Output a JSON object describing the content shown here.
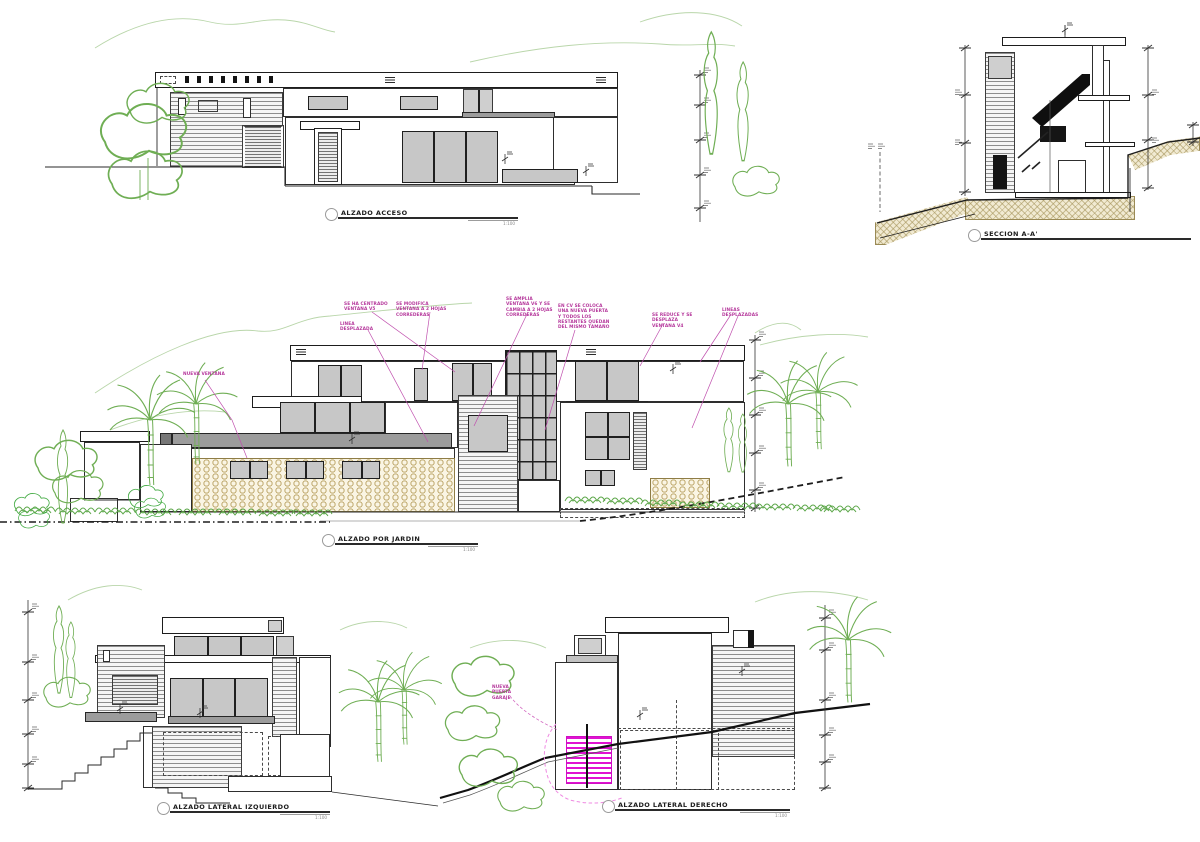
{
  "page": {
    "background": "#ffffff"
  },
  "palette": {
    "line": "#2b2b2b",
    "glass_fill": "#c7c7c7",
    "gray_slab": "#9c9c9c",
    "vegetation_green": "#6fae54",
    "vegetation_bright": "#3fa93f",
    "mountain_green": "#b9d6aa",
    "annotation_magenta": "#b5379b",
    "door_magenta": "#e012d2",
    "stone_tan": "#b29854",
    "earth_hatch": "#9a8a55"
  },
  "drawings": {
    "acceso": {
      "title": "ALZADO ACCESO",
      "scale": "1:100"
    },
    "seccion": {
      "title": "SECCION A-A'",
      "scale": ""
    },
    "jardin": {
      "title": "ALZADO POR JARDIN",
      "scale": "1:100",
      "annotations": {
        "nueva_ventana": "NUEVA VENTANA",
        "linea_desplazada": "LINEA DESPLAZADA",
        "centrado_v5": "SE HA CENTRADO VENTANA V5",
        "modifica": "SE MODIFICA VENTANA A 2 HOJAS CORREDERAS",
        "amplia_v6": "SE AMPLIA VENTANA V6 Y SE CAMBIA A 2 HOJAS CORREDERAS",
        "cv_nuevo": "EN CV SE COLOCA UNA NUEVA PUERTA Y TODOS LOS RESTANTES QUEDAN DEL MISMO TAMAÑO",
        "reduce_v4": "SE REDUCE Y SE DESPLAZA VENTANA V4",
        "lineas_desplazadas": "LINEAS DESPLAZADAS"
      }
    },
    "lateral_izquierdo": {
      "title": "ALZADO LATERAL IZQUIERDO",
      "scale": "1:100"
    },
    "lateral_derecho": {
      "title": "ALZADO LATERAL DERECHO",
      "scale": "1:100",
      "annotations": {
        "nueva_puerta": "NUEVA PUERTA GARAJE"
      }
    }
  }
}
